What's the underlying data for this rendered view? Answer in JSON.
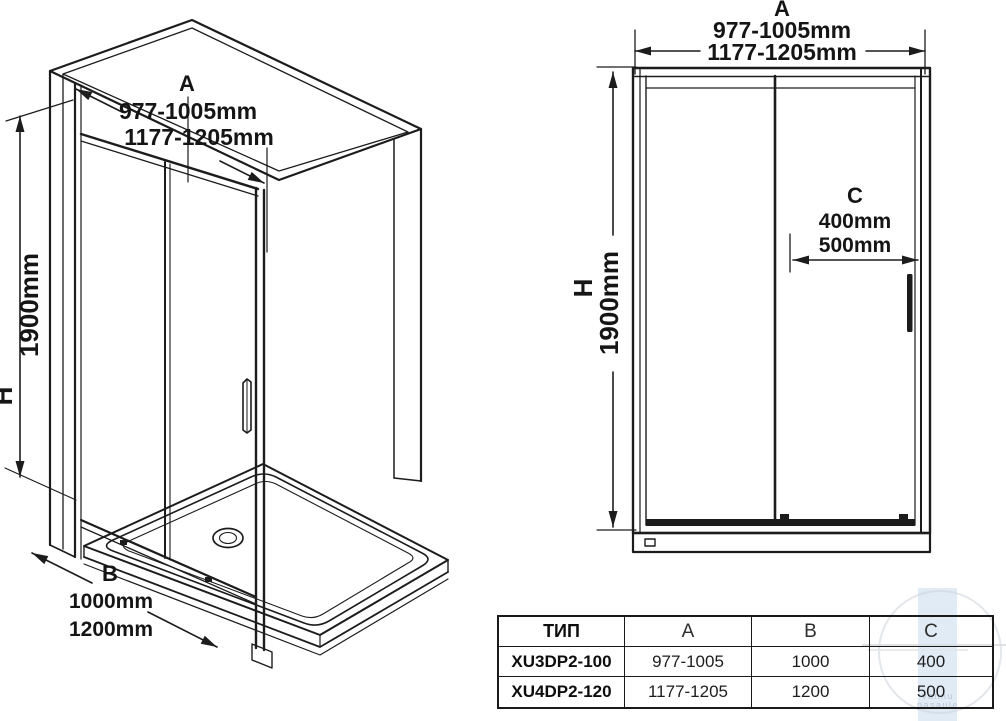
{
  "drawing": {
    "left_view": {
      "dim_a_label": "A",
      "dim_a_range_small": "977-1005mm",
      "dim_a_range_large": "1177-1205mm",
      "dim_h_label": "H",
      "dim_h_value": "1900mm",
      "dim_b_label": "B",
      "dim_b_value_small": "1000mm",
      "dim_b_value_large": "1200mm"
    },
    "right_view": {
      "dim_a_label": "A",
      "dim_a_range_small": "977-1005mm",
      "dim_a_range_large": "1177-1205mm",
      "dim_h_label": "H",
      "dim_h_value": "1900mm",
      "dim_c_label": "C",
      "dim_c_value_small": "400mm",
      "dim_c_value_large": "500mm"
    }
  },
  "table": {
    "headers": [
      "ТИП",
      "A",
      "B",
      "C"
    ],
    "rows": [
      {
        "type": "XU3DP2-100",
        "a": "977-1005",
        "b": "1000",
        "c": "400"
      },
      {
        "type": "XU4DP2-120",
        "a": "1177-1205",
        "b": "1200",
        "c": "500"
      }
    ]
  },
  "watermark": {
    "line1": "vannu",
    "line2": "pasaule"
  },
  "colors": {
    "line": "#1c1c1c",
    "watermark_band": "#d9e6f3",
    "watermark_accent": "#ccd4db",
    "table_border": "#1a1a1a"
  }
}
